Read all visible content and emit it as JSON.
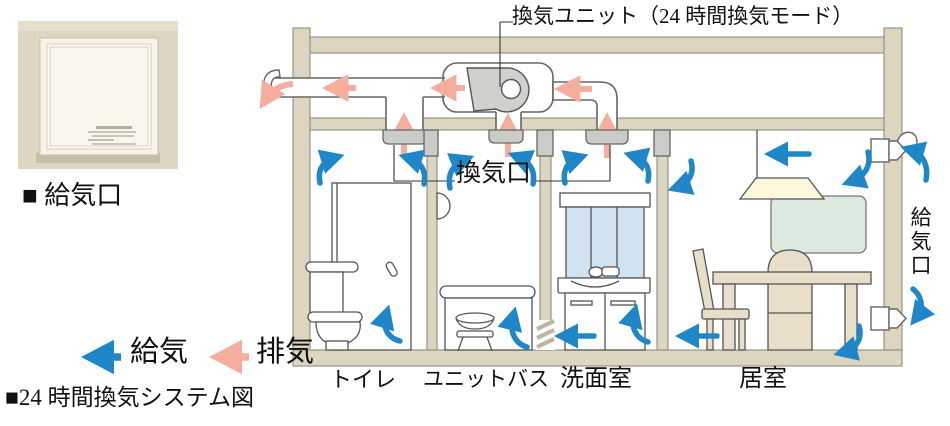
{
  "photo": {
    "caption": "■ 給気口"
  },
  "diagram": {
    "unit_label": "換気ユニット（24 時間換気モード）",
    "ceiling_vent_label": "換気口",
    "wall_supply_label": "給気口",
    "rooms": {
      "toilet": "トイレ",
      "unit_bath": "ユニットバス",
      "washroom": "洗面室",
      "living_room": "居室"
    }
  },
  "legend": {
    "supply_label": "給気",
    "exhaust_label": "排気"
  },
  "caption_title": "■24 時間換気システム図",
  "colors": {
    "supply_blue": "#1f87c8",
    "exhaust_pink": "#f5ae9d",
    "wall_beige": "#dcd5bf",
    "vent_gray": "#cbcbc7"
  }
}
